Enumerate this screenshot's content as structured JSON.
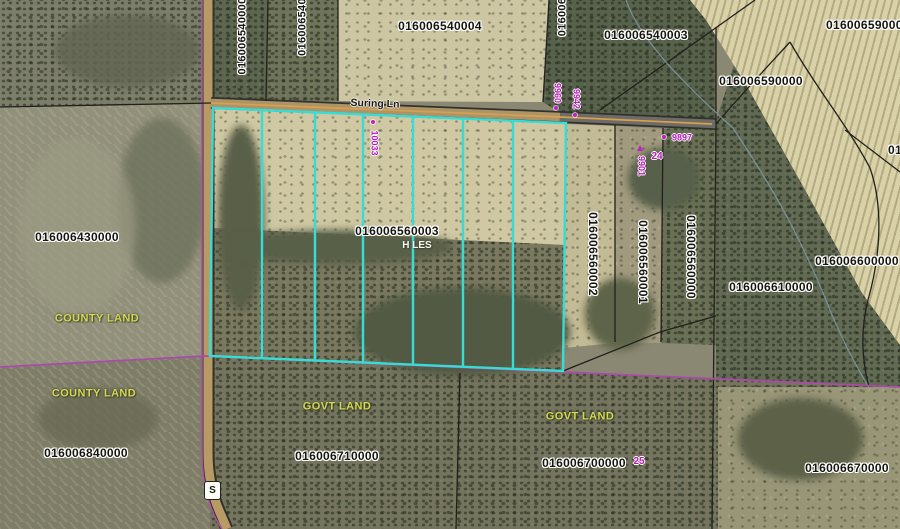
{
  "map": {
    "road": {
      "name": "Suring Ln",
      "shield": "S"
    },
    "parcels": {
      "n540000": "016006540000",
      "n540_cut": "016006540",
      "n540004": "016006540004",
      "n006_cut": "016006",
      "n540003": "016006540003",
      "n590000_corner": "016006590000",
      "n590000": "016006590000",
      "n430000": "016006430000",
      "n560003": "016006560003",
      "n560002": "016006560002",
      "n560001": "016006560001",
      "n560000": "016006560000",
      "n600000": "016006600000",
      "n610000": "016006610000",
      "n840000": "016006840000",
      "n710000": "016006710000",
      "n700000": "016006700000",
      "n670000": "016006670000",
      "n_right_cut": "01"
    },
    "owner_label": "H LES",
    "land": {
      "county1": "COUNTY LAND",
      "county2": "COUNTY LAND",
      "govt1": "GOVT LAND",
      "govt2": "GOVT LAND"
    },
    "addresses": {
      "a10033": "10033",
      "a9960": "9960",
      "a9942": "9942",
      "a9897": "9897",
      "a9901": "9901"
    },
    "lots": {
      "l24": "24",
      "l25": "25"
    },
    "colors": {
      "highlight_cyan": "#36dcd6",
      "boundary_magenta": "#ad49ad",
      "label_yellow": "#d3d954",
      "address_magenta": "#bb17bb",
      "road_tan": "#b89b64"
    }
  }
}
